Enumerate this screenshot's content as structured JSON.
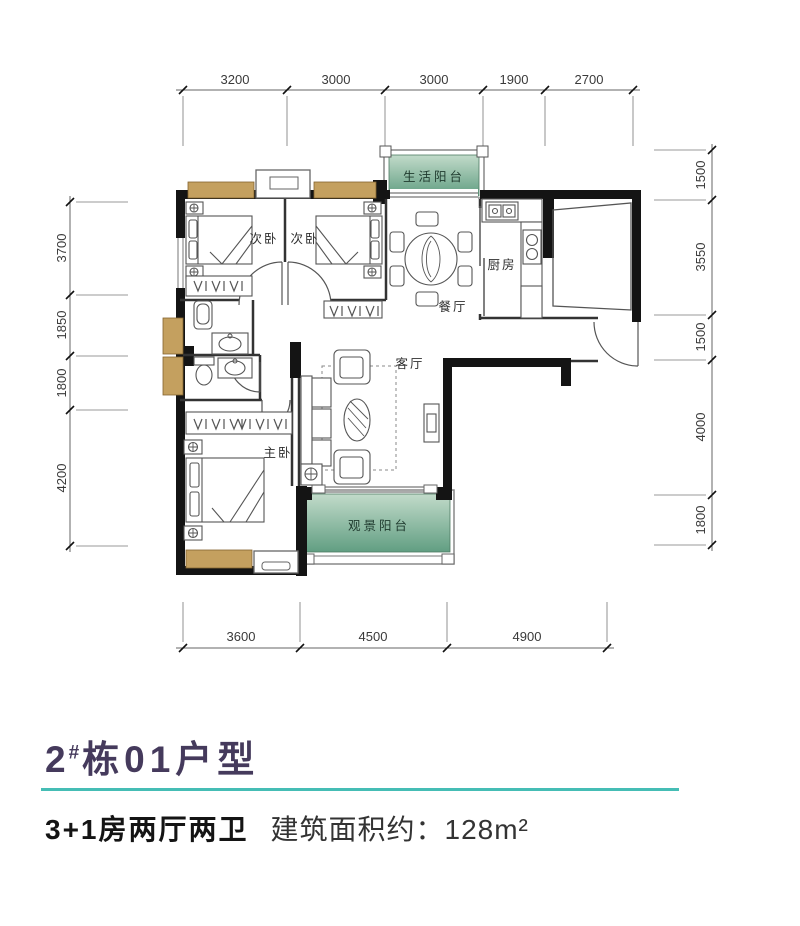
{
  "plan": {
    "rooms": {
      "bedroom_a": "次卧",
      "bedroom_b": "次卧",
      "life_balcony": "生活阳台",
      "kitchen": "厨房",
      "dining": "餐厅",
      "living": "客厅",
      "master": "主卧",
      "view_balcony": "观景阳台"
    },
    "dims": {
      "top": [
        "3200",
        "3000",
        "3000",
        "1900",
        "2700"
      ],
      "left": [
        "3700",
        "1850",
        "1800",
        "4200"
      ],
      "right": [
        "1500",
        "3550",
        "1500",
        "4000",
        "1800"
      ],
      "bottom": [
        "3600",
        "4500",
        "4900"
      ]
    }
  },
  "footer": {
    "unit_number": "2",
    "unit_hash": "#",
    "unit_suffix": "栋01户型",
    "layout_text": "3+1房两厅两卫",
    "area_text": "建筑面积约：128m²"
  },
  "colors": {
    "accent_teal": "#45bdb5",
    "title_purple": "#453a5c",
    "balcony_green_light": "#c2dbca",
    "balcony_green_dark": "#619e82",
    "bay_window_tan": "#c4a05f",
    "wall_black": "#141414"
  }
}
